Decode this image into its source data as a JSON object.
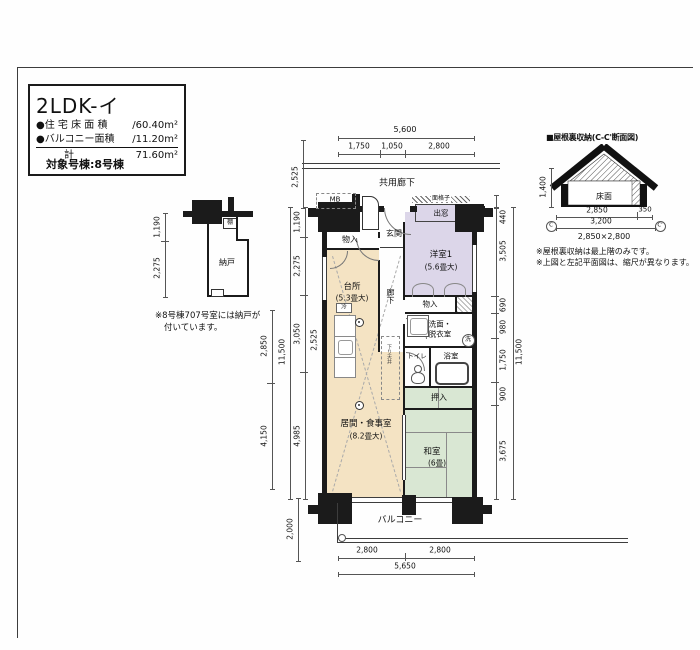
{
  "title_block": {
    "plan_name": "2LDK-イ",
    "area_rows": [
      {
        "label": "●住 宅 床 面 積",
        "value": "/60.40m²"
      },
      {
        "label": "●バルコニー面積",
        "value": "/11.20m²"
      },
      {
        "label": "計",
        "value": "71.60m²"
      }
    ]
  },
  "target_label": "対象号棟:8号棟",
  "storage_plan": {
    "room": "納戸",
    "shelf": "棚",
    "dim_upper": "1,190",
    "dim_lower": "2,275",
    "note1": "※8号棟707号室には納戸が",
    "note2": "付いています。"
  },
  "plan": {
    "corridor": "共用廊下",
    "balcony": "バルコニー",
    "mb": "MB",
    "genkan": "玄関",
    "monoire_top": "物入",
    "kitchen": "台所",
    "kitchen_size": "(5.3畳大)",
    "hallway": "廊下",
    "bedroom": "洋室1",
    "bedroom_size": "(5.6畳大)",
    "menkoushi": "面格子",
    "demado": "出窓",
    "monoire_mid": "物入",
    "senmen1": "洗面・",
    "senmen2": "脱衣室",
    "toilet": "トイレ",
    "bath": "浴室",
    "oshiire": "押入",
    "washitsu": "和室",
    "washitsu_size": "(6畳)",
    "living": "居間・食事室",
    "living_size": "(8.2畳大)",
    "fridge": "冷",
    "wash_mark": "洗",
    "sagari": "下り天井"
  },
  "dims": {
    "top_total": "5,600",
    "top_seg1": "1,750",
    "top_seg2": "1,050",
    "top_seg3": "2,800",
    "left_corridor": "2,525",
    "left_seg1": "1,190",
    "left_seg2": "2,275",
    "left_seg3": "3,050",
    "left_seg4": "4,985",
    "left_total": "11,500",
    "outer1": "2,850",
    "outer2": "4,150",
    "inner": "2,525",
    "balcony_depth": "2,000",
    "bay": "440",
    "right_seg1": "3,505",
    "right_seg2": "690",
    "right_seg3": "980",
    "right_seg4": "1,750",
    "right_seg5": "900",
    "right_seg6": "3,675",
    "right_total": "11,500",
    "bottom_seg1": "2,800",
    "bottom_seg2": "2,800",
    "bottom_total": "5,650"
  },
  "attic": {
    "title": "■屋根裏収納(C-C'断面図)",
    "floor": "床面",
    "height": "1,400",
    "w1": "2,850",
    "w2": "350",
    "w_total": "3,200",
    "size": "2,850×2,800",
    "c_left": "C",
    "c_right": "C'",
    "note1": "※屋根裏収納は最上階のみです。",
    "note2": "※上図と左記平面図は、縮尺が異なります。"
  }
}
